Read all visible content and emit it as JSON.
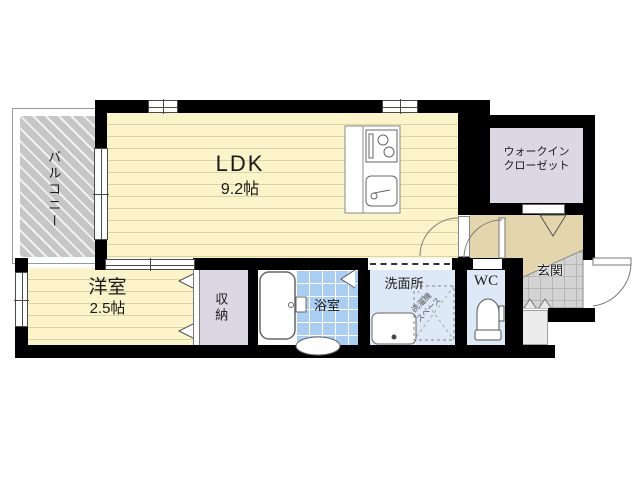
{
  "plan": {
    "rooms": {
      "balcony": {
        "label": "バルコニー"
      },
      "ldk": {
        "label": "LDK",
        "size": "9.2帖"
      },
      "walk_in_closet": {
        "line1": "ウォークイン",
        "line2": "クローゼット"
      },
      "western_room": {
        "label": "洋室",
        "size": "2.5帖"
      },
      "storage": {
        "label": "収納"
      },
      "bathroom": {
        "label": "浴室"
      },
      "washroom": {
        "label": "洗面所"
      },
      "washer_space": {
        "line1": "洗濯機",
        "line2": "スペース"
      },
      "wc": {
        "label": "WC"
      },
      "entrance": {
        "label": "玄関"
      }
    },
    "colors": {
      "wall": "#000000",
      "floor": "#fbf4cb",
      "floor_stripe": "#dcd2a4",
      "balcony": "#c6c6c6",
      "closet": "#dbd8e3",
      "hallway": "#e3d5ac",
      "bath_tile": "#a9cef2",
      "wet_room": "#dee9f7",
      "genkan": "#d3d3d3",
      "genkan_line": "#9b9b9b",
      "outline": "#666666"
    }
  }
}
